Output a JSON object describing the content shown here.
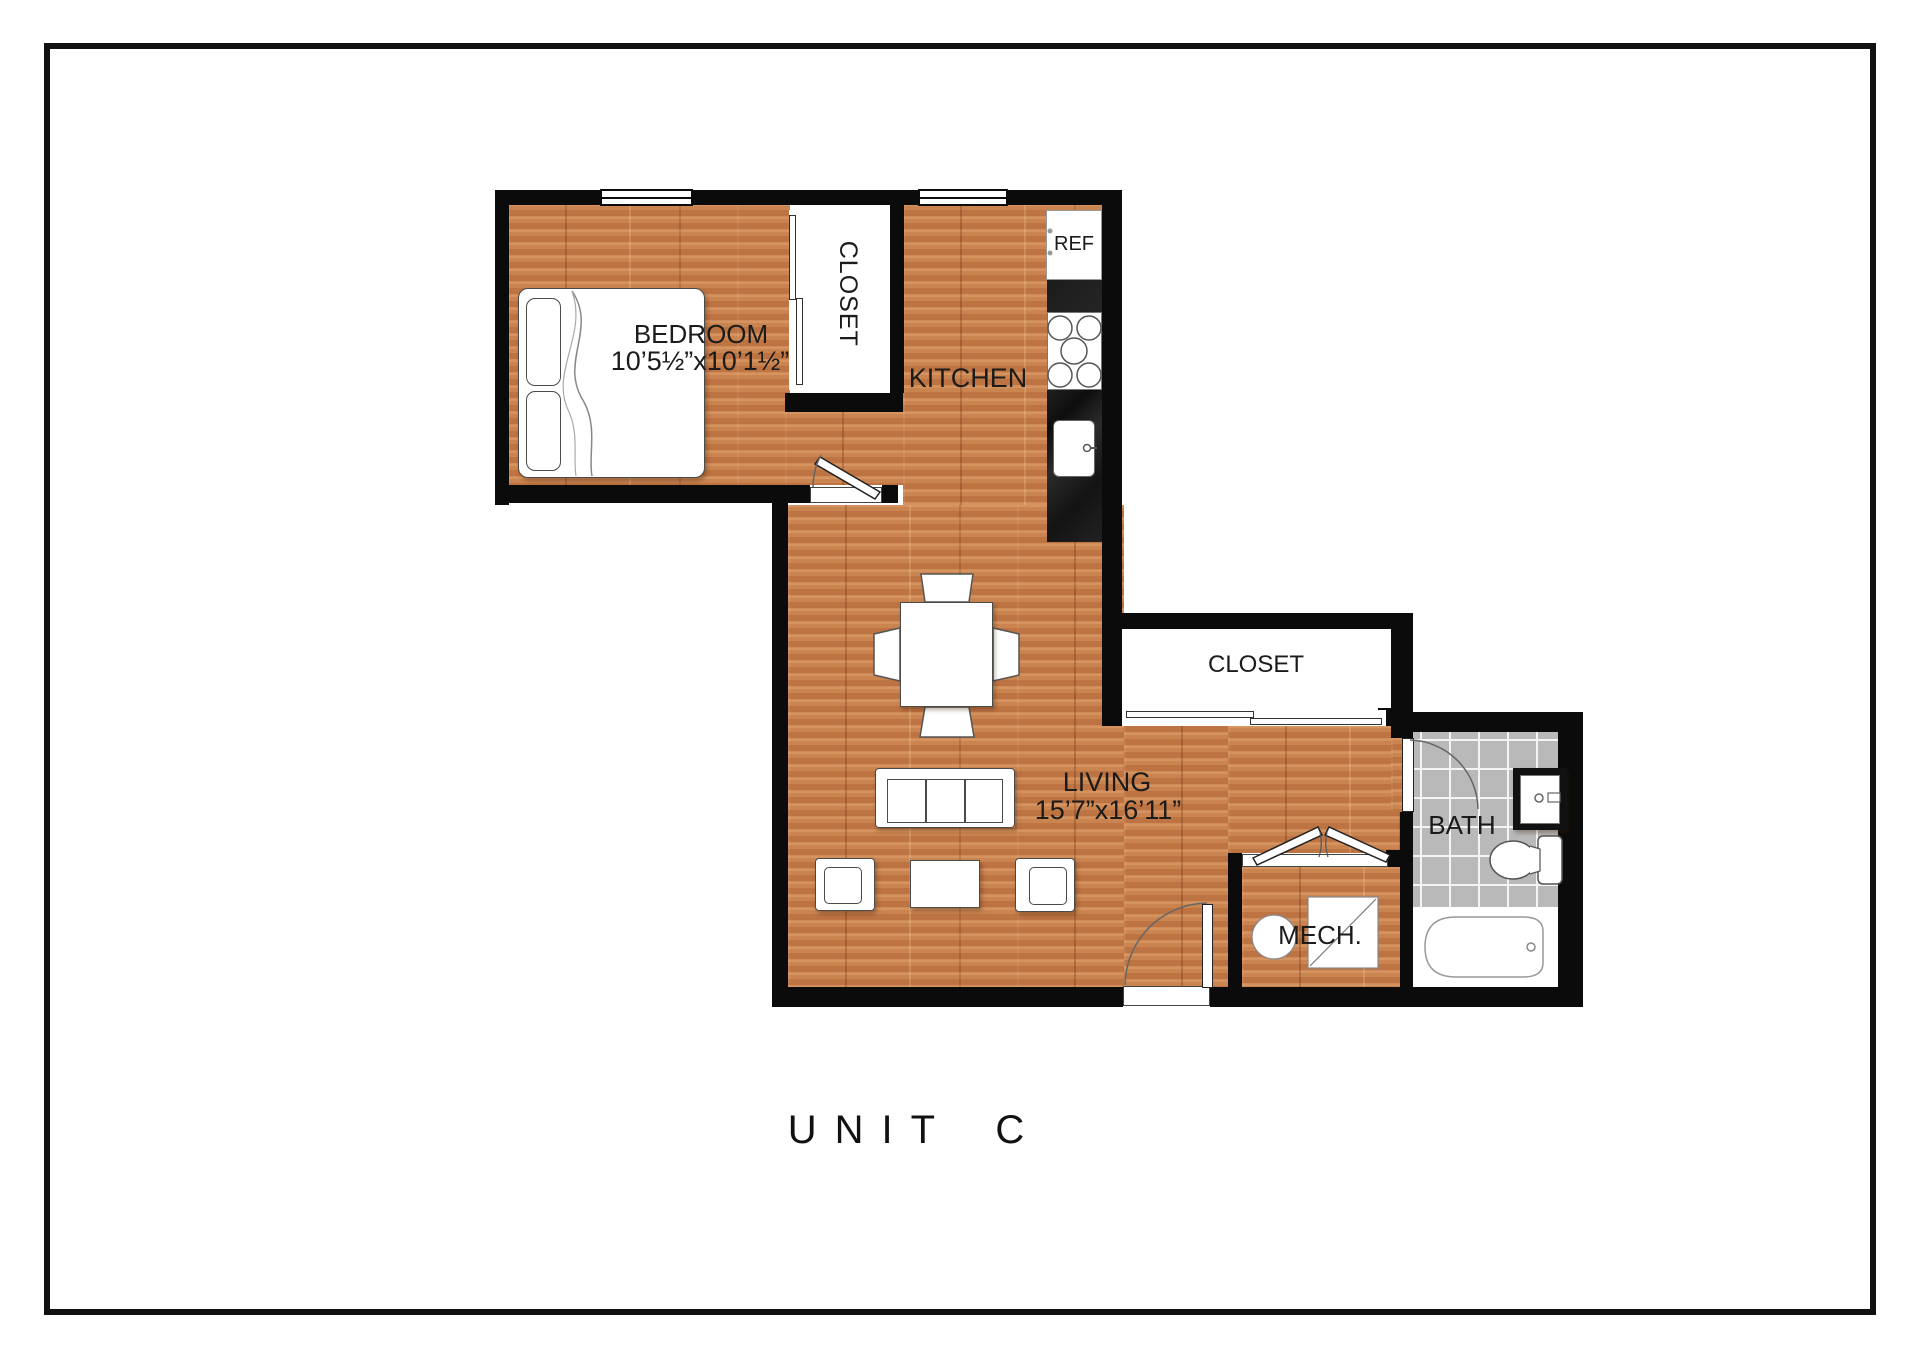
{
  "title": "UNIT C",
  "rooms": {
    "bedroom": {
      "label": "BEDROOM",
      "dims": "10’5½”x10’1½”"
    },
    "bedroom_closet": {
      "label": "CLOSET"
    },
    "kitchen": {
      "label": "KITCHEN"
    },
    "refrigerator": {
      "label": "REF"
    },
    "living": {
      "label": "LIVING",
      "dims": "15’7”x16’11”"
    },
    "hall_closet": {
      "label": "CLOSET"
    },
    "bath": {
      "label": "BATH"
    },
    "mech": {
      "label": "MECH."
    }
  },
  "colors": {
    "wall": "#0b0b0b",
    "wood_floor": "#c9824d",
    "bath_tile": "#b9b9b9",
    "counter": "#1a1a1a",
    "page_frame": "#111111"
  }
}
